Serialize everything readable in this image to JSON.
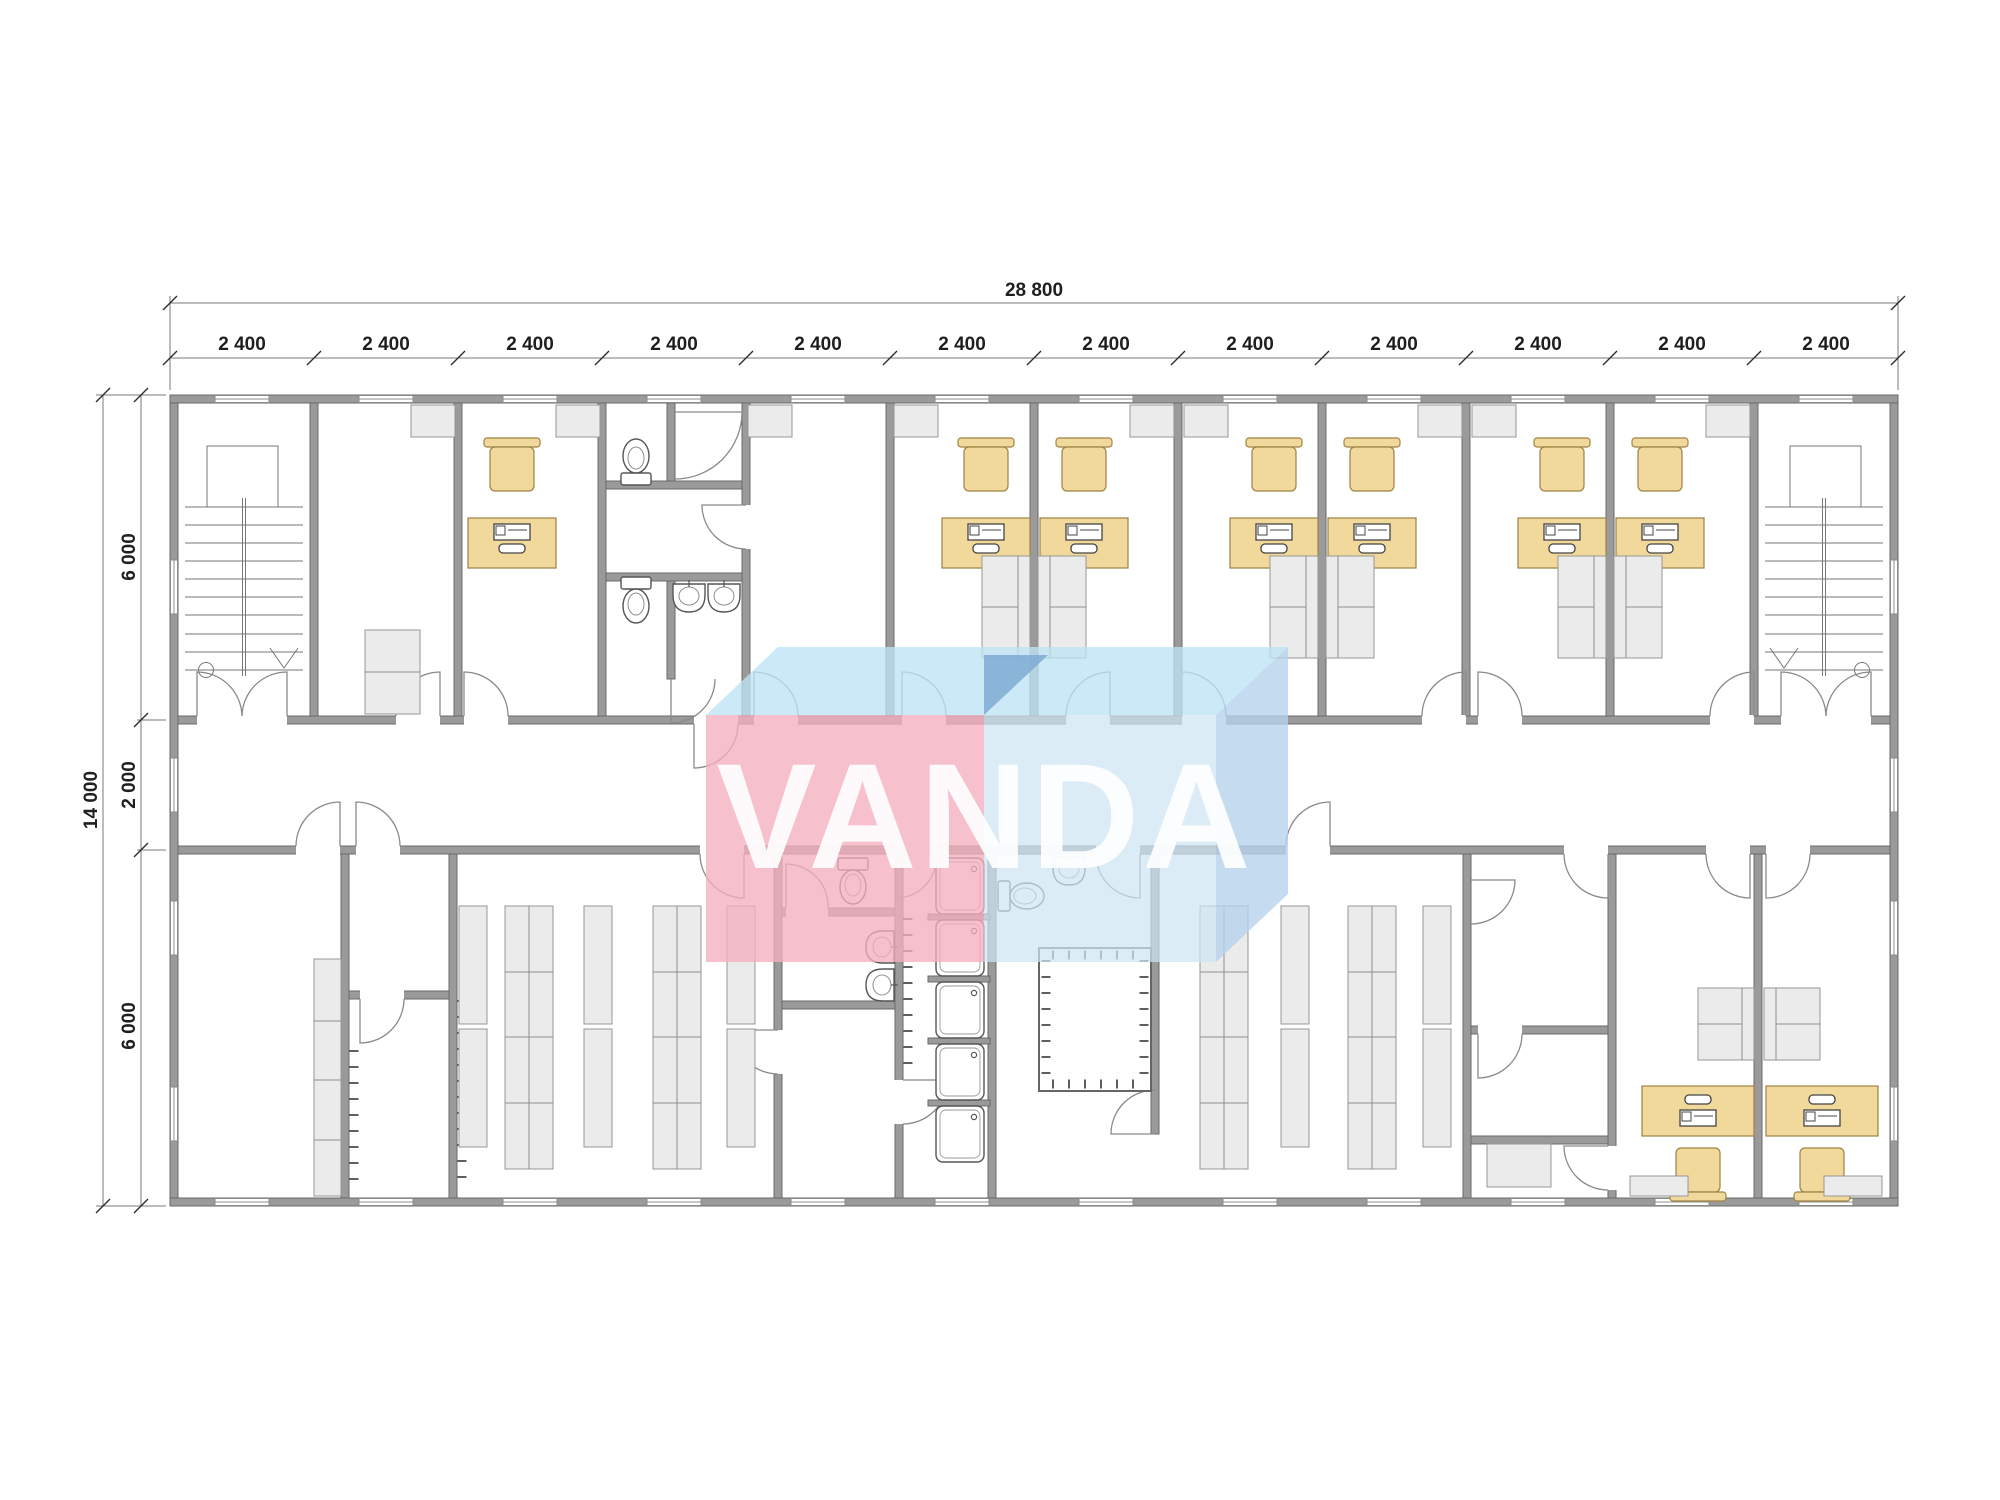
{
  "watermark": {
    "text": "VANDA",
    "colors": {
      "wm_front": "rgba(243,175,190,0.78)",
      "wm_top": "rgba(189,227,244,0.78)",
      "wm_box_front": "rgba(205,228,243,0.72)",
      "wm_box_top": "rgba(189,227,244,0.78)",
      "wm_box_side": "rgba(182,210,235,0.8)",
      "wm_fold": "rgba(128,170,212,0.85)",
      "wm_text": "#ffffff"
    }
  },
  "dimensions": {
    "overall_width_label": "28 800",
    "width_segment_labels": [
      "2 400",
      "2 400",
      "2 400",
      "2 400",
      "2 400",
      "2 400",
      "2 400",
      "2 400",
      "2 400",
      "2 400",
      "2 400",
      "2 400"
    ],
    "overall_height_label": "14 000",
    "height_segment_labels": [
      "6 000",
      "2 000",
      "6 000"
    ]
  },
  "plan": {
    "colors": {
      "wall": "#9a9a9a",
      "wall_edge": "#696969",
      "furniture_fill": "#f1d89b",
      "furniture_stroke": "#9d8345",
      "storage_fill": "#ebebeb",
      "storage_stroke": "#979797",
      "fixture_stroke": "#555555",
      "door_arc": "#8a8a8a",
      "dim_text": "#1f1f1f",
      "dim_line": "#7a7a7a"
    },
    "fixtures": {
      "stairwells": 2,
      "office_desks_with_computers": 9,
      "office_chairs": 9,
      "sofa_units": 8,
      "cabinets_and_shelves": 14,
      "toilets": 4,
      "wash_basins": 5,
      "shower_stalls": 5,
      "storage_rack_columns": 9,
      "hatched_technical_rooms": 1,
      "corridor_count": 1
    }
  }
}
